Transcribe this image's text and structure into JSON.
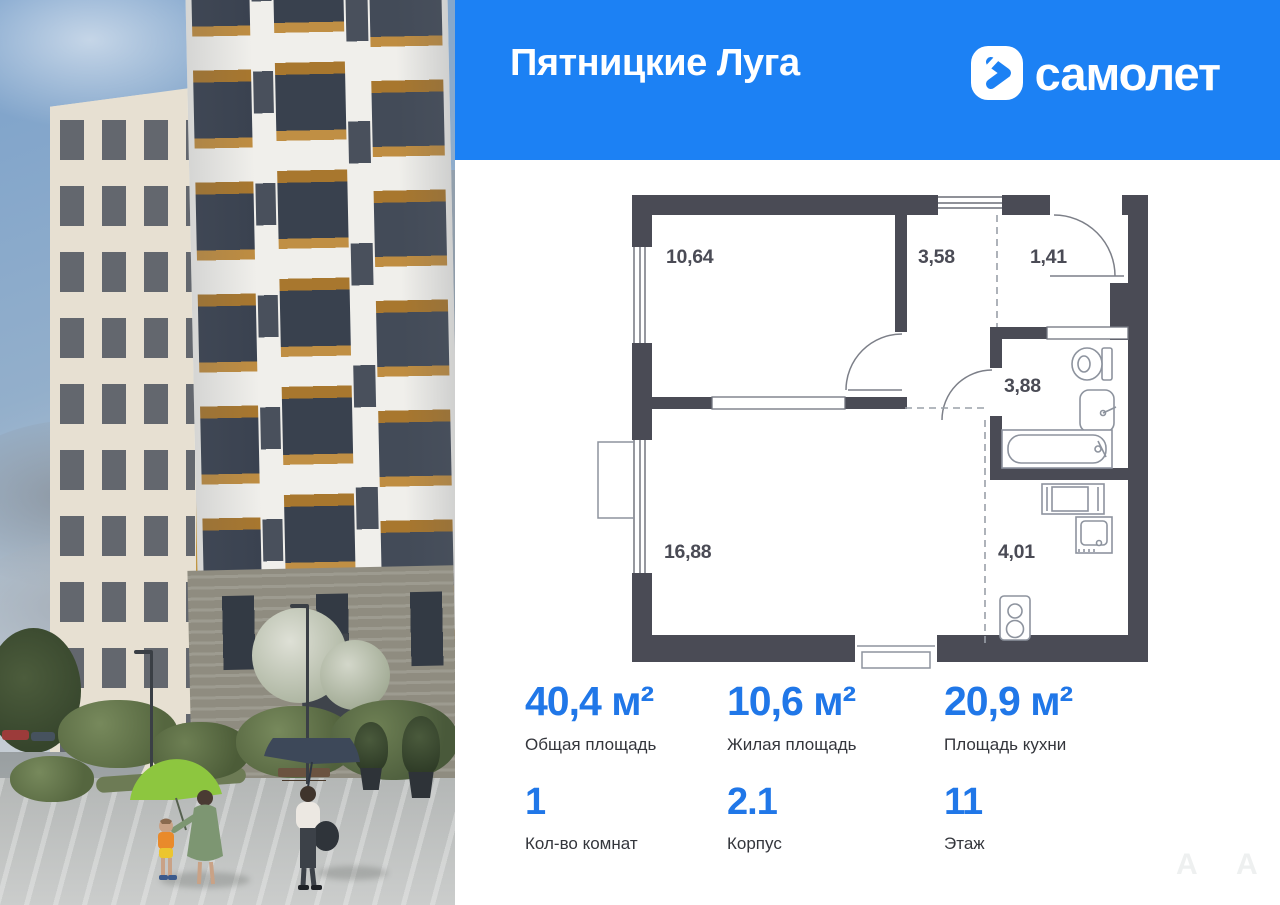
{
  "header": {
    "project_title": "Пятницкие Луга",
    "brand_wordmark": "самолет"
  },
  "floor_plan": {
    "rooms": [
      {
        "name": "bedroom",
        "area": "10,64"
      },
      {
        "name": "hallway",
        "area": "3,58"
      },
      {
        "name": "entry",
        "area": "1,41"
      },
      {
        "name": "bathroom",
        "area": "3,88"
      },
      {
        "name": "living-room",
        "area": "16,88"
      },
      {
        "name": "kitchen",
        "area": "4,01"
      }
    ]
  },
  "stats": {
    "row1": [
      {
        "value": "40,4 м²",
        "label": "Общая площадь"
      },
      {
        "value": "10,6 м²",
        "label": "Жилая площадь"
      },
      {
        "value": "20,9 м²",
        "label": "Площадь кухни"
      }
    ],
    "row2": [
      {
        "value": "1",
        "label": "Кол-во комнат"
      },
      {
        "value": "2.1",
        "label": "Корпус"
      },
      {
        "value": "11",
        "label": "Этаж"
      }
    ]
  },
  "watermarks": {
    "letters": [
      "А",
      "А"
    ]
  },
  "colors": {
    "header_bg": "#1c81f4",
    "accent_blue": "#2077e8",
    "wall": "#4a4b55",
    "label_text": "#34363c",
    "fixture_gray": "#8d939e"
  }
}
